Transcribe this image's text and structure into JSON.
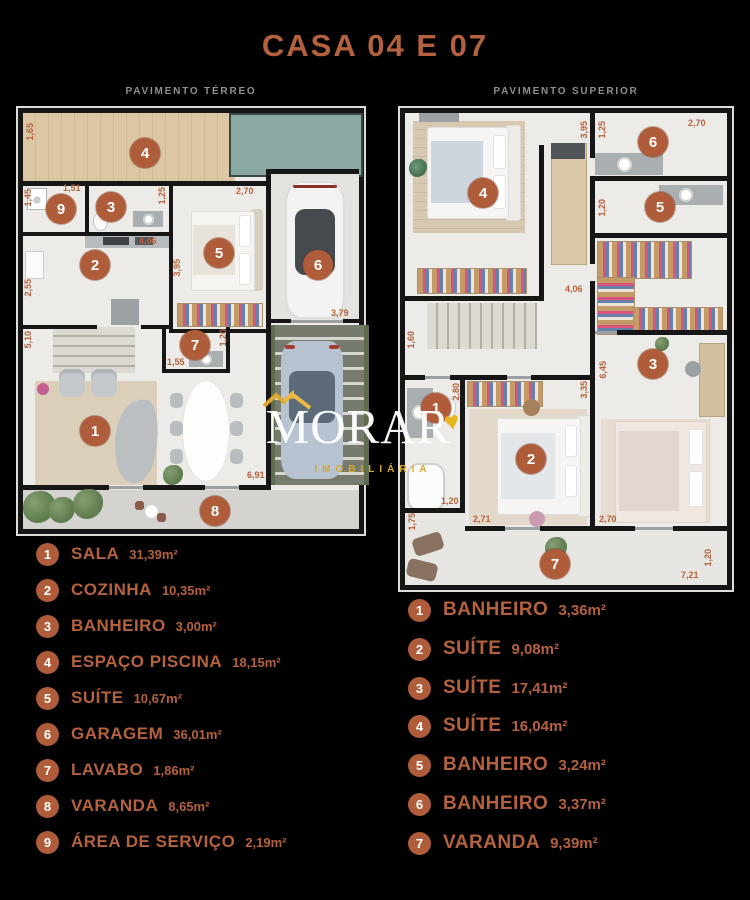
{
  "title": {
    "casa": "CASA",
    "num1": "04",
    "conj": "E",
    "num2": "07"
  },
  "plans": {
    "terreo": {
      "heading": "PAVIMENTO TÉRREO",
      "dims": {
        "v165": "1,65",
        "v151": "1,51",
        "v145": "1,45",
        "v125": "1,25",
        "v270": "2,70",
        "v406": "4,06",
        "v255": "2,55",
        "v395": "3,95",
        "v510": "5,10",
        "v120": "1,20",
        "v155": "1,55",
        "v379": "3,79",
        "v691": "6,91"
      }
    },
    "superior": {
      "heading": "PAVIMENTO SUPERIOR",
      "dims": {
        "v395": "3,95",
        "v125": "1,25",
        "v270a": "2,70",
        "v120a": "1,20",
        "v406": "4,06",
        "v160": "1,60",
        "v280": "2,80",
        "v335": "3,35",
        "v645": "6,45",
        "v120b": "1,20",
        "v271": "2,71",
        "v270b": "2,70",
        "v175": "1,75",
        "v721": "7,21",
        "v120c": "1,20"
      }
    }
  },
  "legend_left": {
    "items": [
      {
        "num": "1",
        "name": "SALA",
        "area": "31,39m²"
      },
      {
        "num": "2",
        "name": "COZINHA",
        "area": "10,35m²"
      },
      {
        "num": "3",
        "name": "BANHEIRO",
        "area": "3,00m²"
      },
      {
        "num": "4",
        "name": "ESPAÇO PISCINA",
        "area": "18,15m²"
      },
      {
        "num": "5",
        "name": "SUÍTE",
        "area": "10,67m²"
      },
      {
        "num": "6",
        "name": "GARAGEM",
        "area": "36,01m²"
      },
      {
        "num": "7",
        "name": "LAVABO",
        "area": "1,86m²"
      },
      {
        "num": "8",
        "name": "VARANDA",
        "area": "8,65m²"
      },
      {
        "num": "9",
        "name": "ÁREA DE SERVIÇO",
        "area": "2,19m²"
      }
    ]
  },
  "legend_right": {
    "items": [
      {
        "num": "1",
        "name": "BANHEIRO",
        "area": "3,36m²"
      },
      {
        "num": "2",
        "name": "SUÍTE",
        "area": "9,08m²"
      },
      {
        "num": "3",
        "name": "SUÍTE",
        "area": "17,41m²"
      },
      {
        "num": "4",
        "name": "SUÍTE",
        "area": "16,04m²"
      },
      {
        "num": "5",
        "name": "BANHEIRO",
        "area": "3,24m²"
      },
      {
        "num": "6",
        "name": "BANHEIRO",
        "area": "3,37m²"
      },
      {
        "num": "7",
        "name": "VARANDA",
        "area": "9,39m²"
      }
    ]
  },
  "logo": {
    "name": "MORAR",
    "tagline": "IMOBILIÁRIA"
  },
  "colors": {
    "accent": "#b4613e",
    "badge": "#ae5c3a",
    "subtitle": "#8f8f8f",
    "background": "#000000",
    "floor": "#edebe7",
    "wall": "#161616",
    "pool": "#8ba9a3",
    "deck": "#dbc7a4",
    "gold": "#dca72e",
    "logo_white": "#ffffff"
  }
}
